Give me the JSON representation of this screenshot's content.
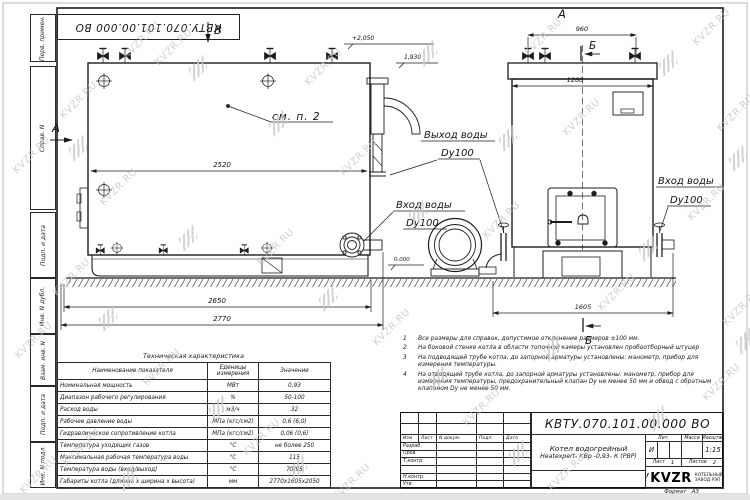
{
  "colors": {
    "line": "#1c1c1c",
    "watermark": "#c5c5c5"
  },
  "watermark": {
    "text": "KVZR.RU"
  },
  "designation_top": "КВТУ.070.101.00.000  ВО",
  "stamp_left": {
    "fields": [
      "Перв. примен.",
      "Справ. N",
      "Подп. и дата",
      "Инв. N дубл.",
      "Взам. инв. N",
      "Подп. и дата",
      "Инв. N подл."
    ]
  },
  "drawing": {
    "side_view": {
      "view_label": "В",
      "direction_label": "А",
      "callout": "см. п. 2",
      "dim_width": "2520",
      "dim_base": "2650",
      "dim_overall": "2770",
      "level_top": "+2,050",
      "level_mid": "1,930",
      "level_zero": "0.000"
    },
    "front_view": {
      "view_label": "А",
      "section_top": "Б",
      "section_bottom": "Б",
      "dim_valves": "960",
      "dim_width": "1260",
      "dim_base": "1605"
    },
    "ports": {
      "outlet_label": "Выход воды",
      "outlet_dn": "Dy100",
      "inlet_label": "Вход воды",
      "inlet_dn": "Dy100",
      "inlet_right_label": "Вход воды",
      "inlet_right_dn": "Dy100"
    }
  },
  "notes": {
    "items": [
      {
        "num": "1",
        "text": "Все размеры для справок, допустимое отклонение размеров ±100 мм."
      },
      {
        "num": "2",
        "text": "На боковой стенке котла в области топочной камеры установлен пробоотборный штуцер"
      },
      {
        "num": "3",
        "text": "На  подводящей трубе котла, до запорной арматуры установлены: манометр, прибор для измерения температуры."
      },
      {
        "num": "4",
        "text": "На отводящей трубе котла, до запорной арматуры установлены: манометр, прибор для измерения температуры, предохранительный клапан Dу не менее 50 мм и обвод с обратным клапаном Dу не менее 50 мм."
      }
    ]
  },
  "tech_table": {
    "title": "Техническая характеристика",
    "headers": [
      "Наименование показателя",
      "Еденицы измерения",
      "Значение"
    ],
    "rows": [
      [
        "Номинальная мощность",
        "МВт",
        "0,93"
      ],
      [
        "Диапазон рабочего регулирования",
        "%",
        "50-100"
      ],
      [
        "Расход воды",
        "м3/ч",
        "32"
      ],
      [
        "Рабочее давление воды",
        "МПа (кгс/см2)",
        "0,6 (6,0)"
      ],
      [
        "Гидравлическое сопротивление котла",
        "МПа (кгс/см2)",
        "0,06 (0,6)"
      ],
      [
        "Температура уходящих газов",
        "°С",
        "не более 250"
      ],
      [
        "Максимальная рабочая температура воды",
        "°С",
        "115"
      ],
      [
        "Температура воды (вход/выход)",
        "°С",
        "70/95"
      ],
      [
        "Габариты котла (длинна х ширина х высота)",
        "мм",
        "2770х1605х2050"
      ]
    ]
  },
  "title_block": {
    "designation": "КВТУ.070.101.00.000  ВО",
    "header_cols": [
      "Изм",
      "Лист",
      "N докум.",
      "Подп.",
      "Дата"
    ],
    "sig_rows": [
      "Разраб.",
      "Пров.",
      "Т.контр.",
      "",
      "Н.контр.",
      "Утв."
    ],
    "product_name_line1": "Котел водогрейный",
    "product_name_line2": "Heatexpert- КВр -0,93- К (РВР)",
    "lit_header": "Лит.",
    "mass_header": "Масса",
    "scale_header": "Масштаб",
    "lit_value": "И",
    "scale_value": "1:15",
    "sheet_label": "Лист",
    "sheet_value": "1",
    "sheets_label": "Листов",
    "sheets_value": "2",
    "logo_text": "KVZR",
    "company_line1": "КОТЕЛЬНЫЙ",
    "company_line2": "ЗАВОД РЭП",
    "format_label": "Формат",
    "format_value": "А3"
  }
}
